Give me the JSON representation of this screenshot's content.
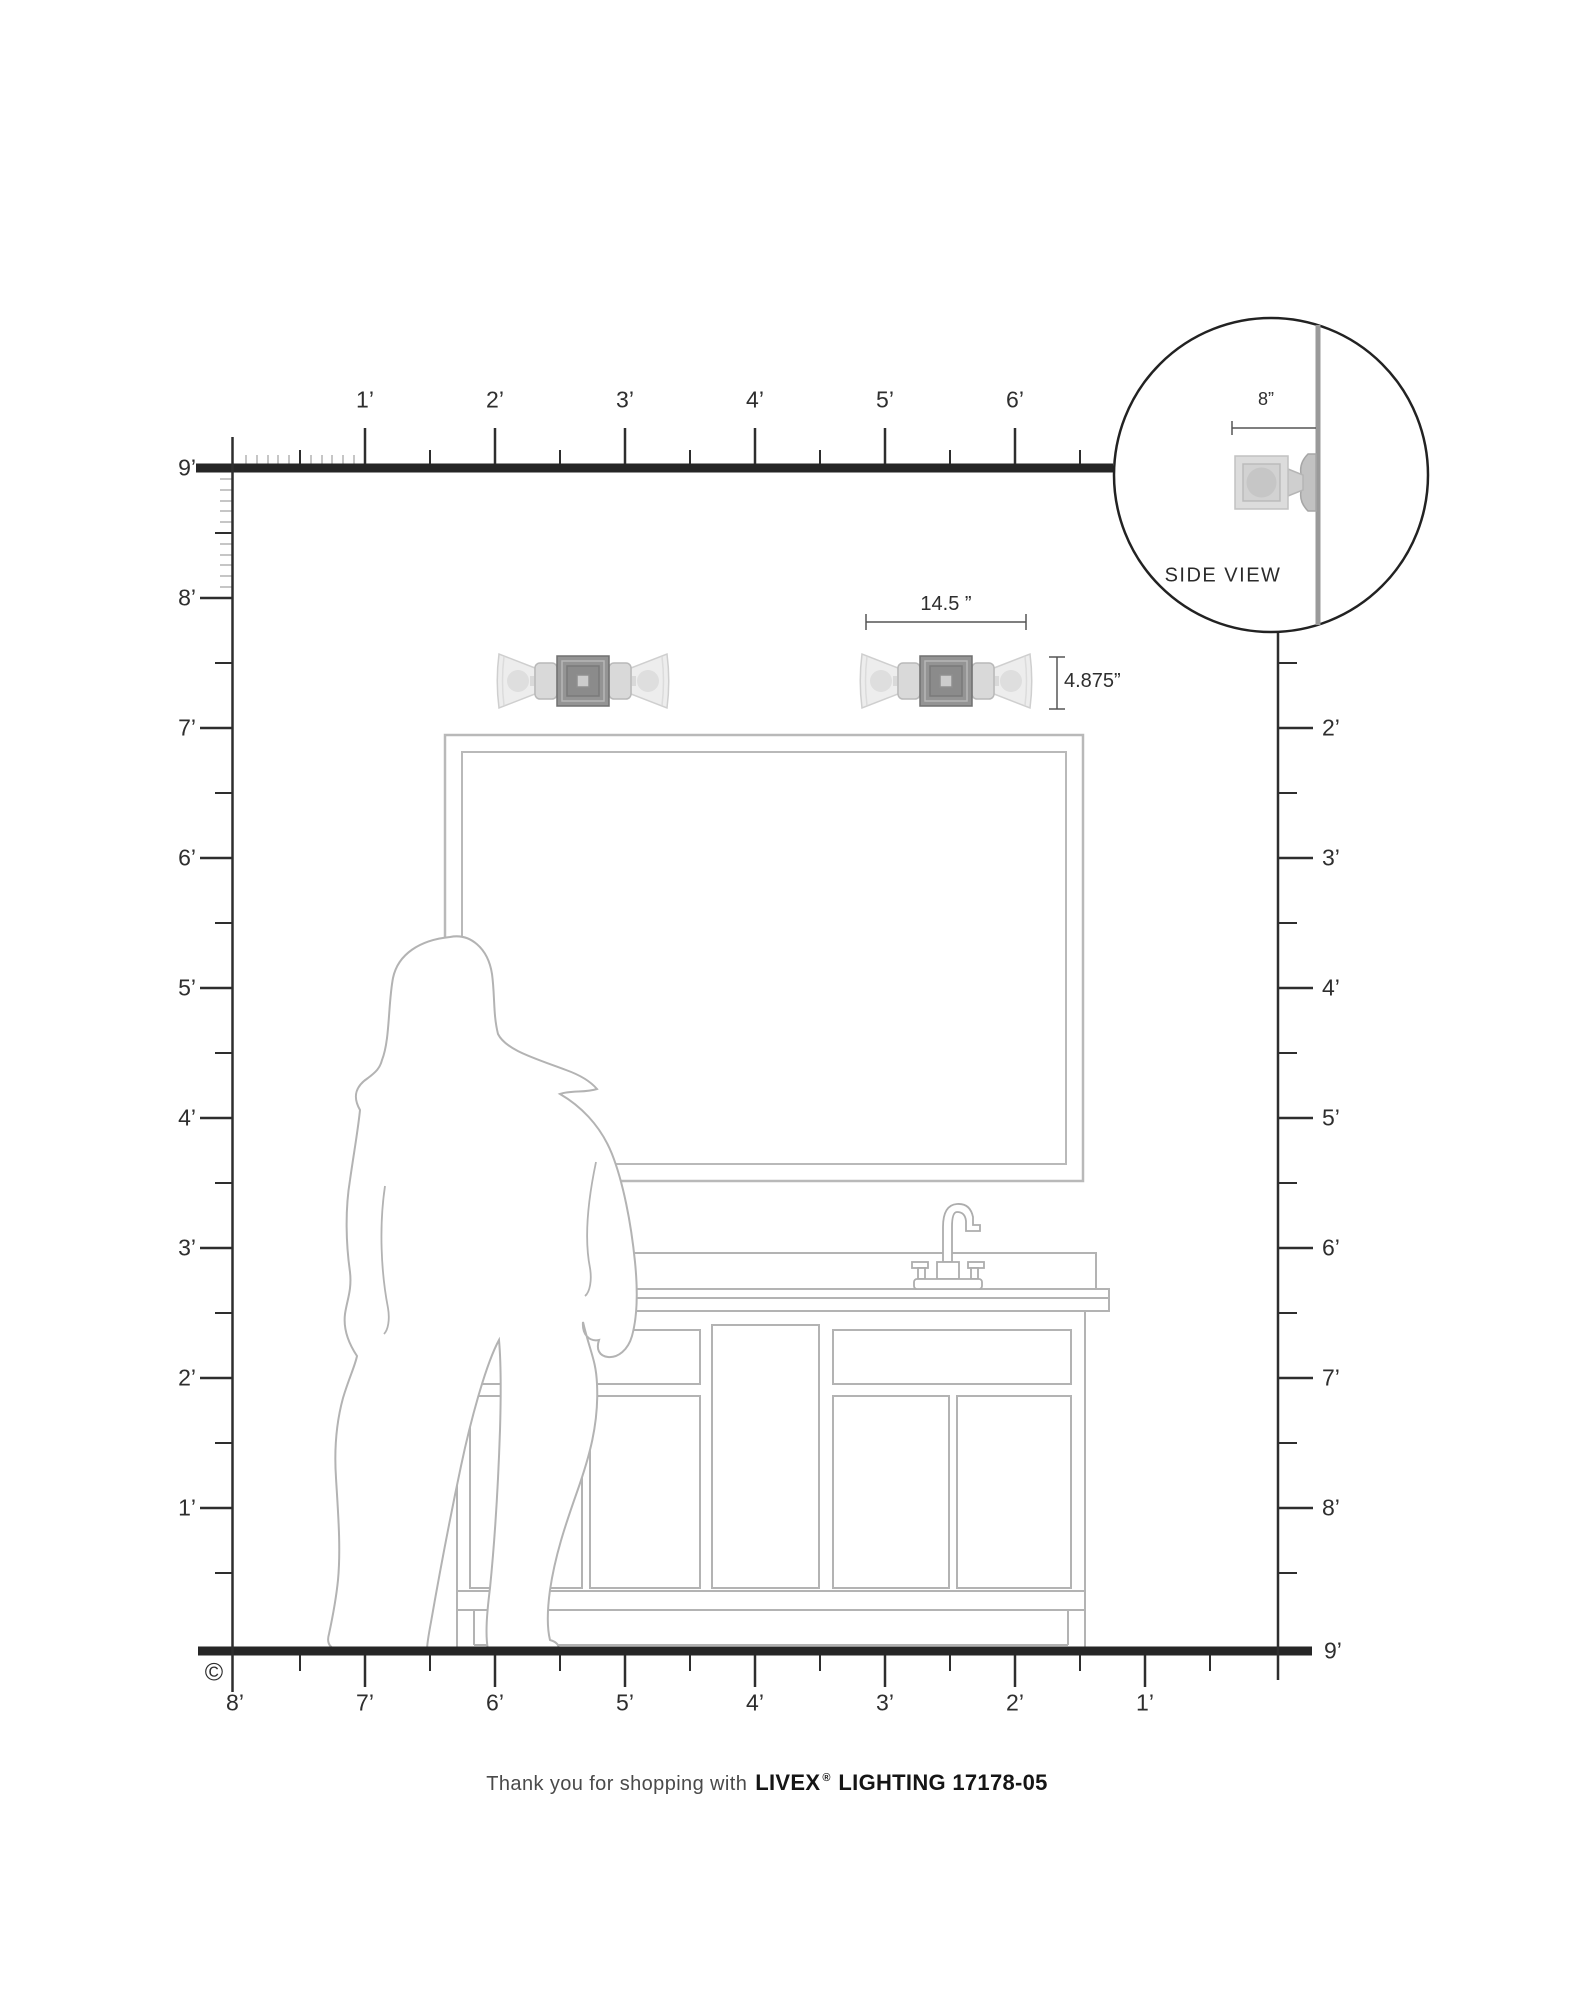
{
  "page": {
    "width": 1588,
    "height": 2000,
    "background": "#ffffff"
  },
  "rulers": {
    "top": {
      "labels": [
        "1’",
        "2’",
        "3’",
        "4’",
        "5’",
        "6’"
      ]
    },
    "left": {
      "labels": [
        "9’",
        "8’",
        "7’",
        "6’",
        "5’",
        "4’",
        "3’",
        "2’",
        "1’"
      ]
    },
    "right": {
      "labels": [
        "2’",
        "3’",
        "4’",
        "5’",
        "6’",
        "7’",
        "8’"
      ],
      "floor_label": "9’"
    },
    "bottom": {
      "labels": [
        "8’",
        "7’",
        "6’",
        "5’",
        "4’",
        "3’",
        "2’",
        "1’"
      ]
    }
  },
  "dimensions": {
    "fixture_width": "14.5 ”",
    "fixture_height": "4.875”",
    "fixture_extension": "8”"
  },
  "inset": {
    "caption": "SIDE VIEW"
  },
  "footer": {
    "copyright": "©",
    "thanks": "Thank you for shopping with",
    "brand": "LIVEX",
    "registered": "®",
    "product": "LIGHTING 17178-05"
  },
  "colors": {
    "ruler_heavy": "#262626",
    "ruler_line": "#2e2e2e",
    "inch_tick": "#c6c6c6",
    "artwork_outline": "#b3b3b3",
    "fixture_plate": "#949494",
    "fixture_shade": "#ededed",
    "inset_wall": "#9a9a9a",
    "text": "#2e2e2e"
  }
}
